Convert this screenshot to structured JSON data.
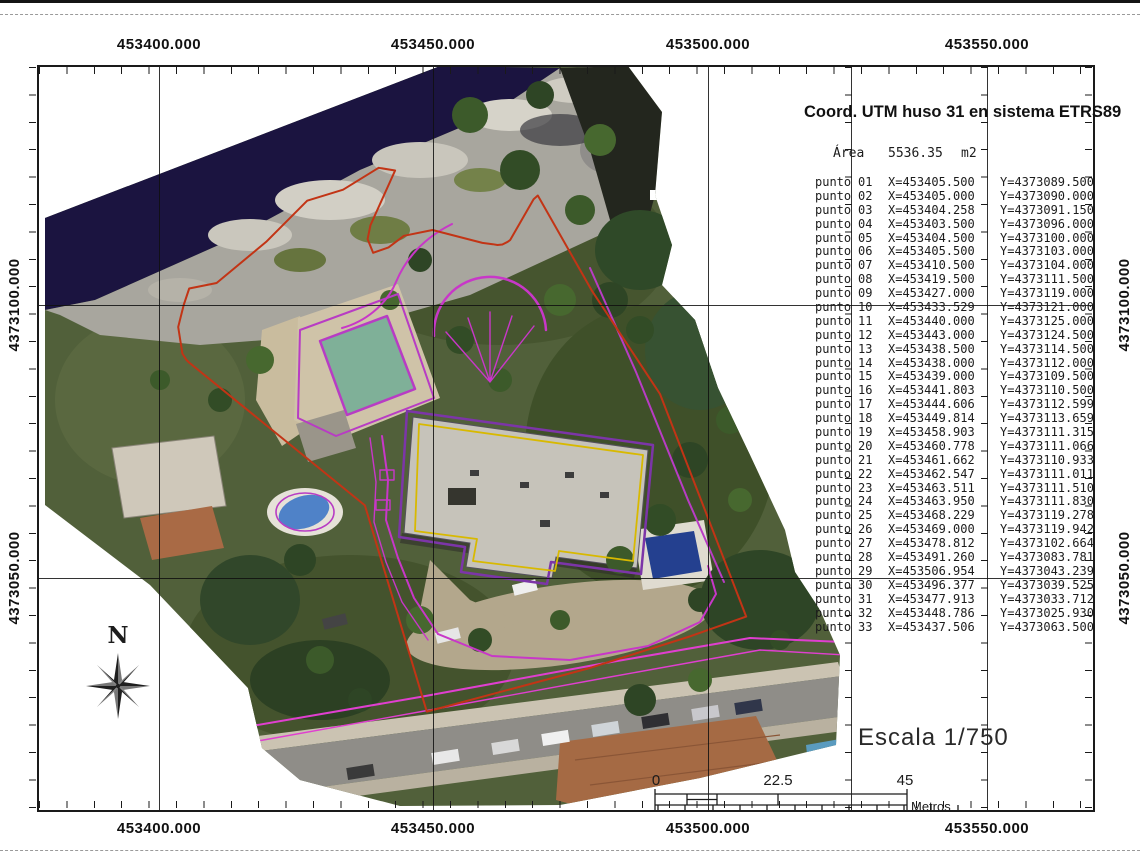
{
  "header": {
    "title": "Coord. UTM huso 31 en sistema ETRS89"
  },
  "area": {
    "label": "Área",
    "value": "5536.35",
    "unit": "m2"
  },
  "point_table": {
    "row_label": "punto",
    "points": [
      {
        "n": "01",
        "x": "X=453405.500",
        "y": "Y=4373089.500"
      },
      {
        "n": "02",
        "x": "X=453405.000",
        "y": "Y=4373090.000"
      },
      {
        "n": "03",
        "x": "X=453404.258",
        "y": "Y=4373091.150"
      },
      {
        "n": "04",
        "x": "X=453403.500",
        "y": "Y=4373096.000"
      },
      {
        "n": "05",
        "x": "X=453404.500",
        "y": "Y=4373100.000"
      },
      {
        "n": "06",
        "x": "X=453405.500",
        "y": "Y=4373103.000"
      },
      {
        "n": "07",
        "x": "X=453410.500",
        "y": "Y=4373104.000"
      },
      {
        "n": "08",
        "x": "X=453419.500",
        "y": "Y=4373111.500"
      },
      {
        "n": "09",
        "x": "X=453427.000",
        "y": "Y=4373119.000"
      },
      {
        "n": "10",
        "x": "X=453433.529",
        "y": "Y=4373121.000"
      },
      {
        "n": "11",
        "x": "X=453440.000",
        "y": "Y=4373125.000"
      },
      {
        "n": "12",
        "x": "X=453443.000",
        "y": "Y=4373124.500"
      },
      {
        "n": "13",
        "x": "X=453438.500",
        "y": "Y=4373114.500"
      },
      {
        "n": "14",
        "x": "X=453438.000",
        "y": "Y=4373112.000"
      },
      {
        "n": "15",
        "x": "X=453439.000",
        "y": "Y=4373109.500"
      },
      {
        "n": "16",
        "x": "X=453441.803",
        "y": "Y=4373110.500"
      },
      {
        "n": "17",
        "x": "X=453444.606",
        "y": "Y=4373112.599"
      },
      {
        "n": "18",
        "x": "X=453449.814",
        "y": "Y=4373113.659"
      },
      {
        "n": "19",
        "x": "X=453458.903",
        "y": "Y=4373111.315"
      },
      {
        "n": "20",
        "x": "X=453460.778",
        "y": "Y=4373111.066"
      },
      {
        "n": "21",
        "x": "X=453461.662",
        "y": "Y=4373110.933"
      },
      {
        "n": "22",
        "x": "X=453462.547",
        "y": "Y=4373111.011"
      },
      {
        "n": "23",
        "x": "X=453463.511",
        "y": "Y=4373111.510"
      },
      {
        "n": "24",
        "x": "X=453463.950",
        "y": "Y=4373111.830"
      },
      {
        "n": "25",
        "x": "X=453468.229",
        "y": "Y=4373119.278"
      },
      {
        "n": "26",
        "x": "X=453469.000",
        "y": "Y=4373119.942"
      },
      {
        "n": "27",
        "x": "X=453478.812",
        "y": "Y=4373102.664"
      },
      {
        "n": "28",
        "x": "X=453491.260",
        "y": "Y=4373083.781"
      },
      {
        "n": "29",
        "x": "X=453506.954",
        "y": "Y=4373043.239"
      },
      {
        "n": "30",
        "x": "X=453496.377",
        "y": "Y=4373039.525"
      },
      {
        "n": "31",
        "x": "X=453477.913",
        "y": "Y=4373033.712"
      },
      {
        "n": "32",
        "x": "X=453448.786",
        "y": "Y=4373025.930"
      },
      {
        "n": "33",
        "x": "X=453437.506",
        "y": "Y=4373063.500"
      }
    ]
  },
  "axes": {
    "x_labels": [
      "453400.000",
      "453450.000",
      "453500.000",
      "453550.000"
    ],
    "y_labels": [
      "4373100.000",
      "4373050.000"
    ]
  },
  "scale_text": "Escala 1/750",
  "scale_bar": {
    "labels": [
      "0",
      "22.5",
      "45"
    ],
    "unit_label": "Metros"
  },
  "compass": {
    "label": "N"
  },
  "colors": {
    "parcel_boundary_red": "#c23415",
    "survey_magenta": "#c837c8",
    "building_outline_yellow": "#d8b900",
    "pool_teal": "#7fb098",
    "pool_blue": "#4f82c8",
    "shadow_navy": "#1b1440"
  }
}
